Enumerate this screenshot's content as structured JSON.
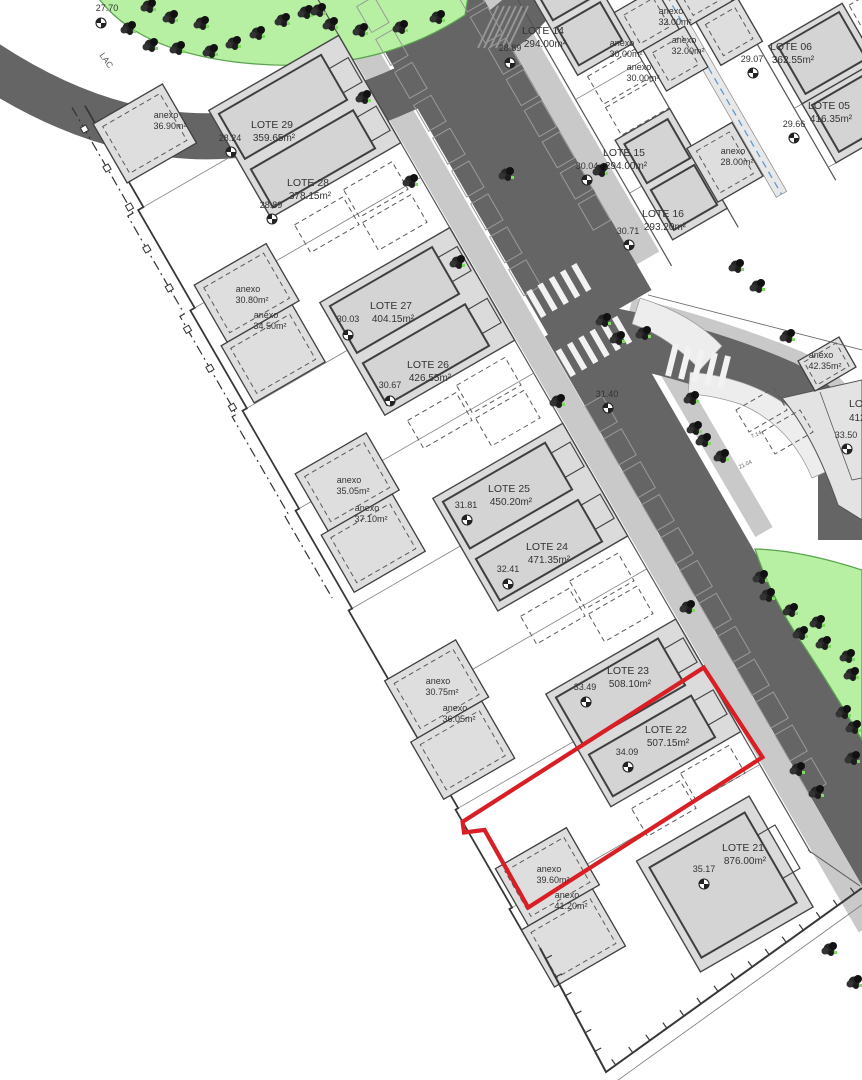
{
  "plan": {
    "boundary_label": {
      "text": "LAC",
      "pos": [
        104,
        62
      ],
      "rotate": 55
    },
    "colors": {
      "highlight": "#d81f26",
      "road": "#656565",
      "sidewalk": "#c9c9c9",
      "parcel_band": "#dbdbdb",
      "green_area": "#b7f0a3",
      "green_stroke": "#5aa34e",
      "line": "#454545",
      "utility_blue": "#5b9bd5"
    },
    "lots": [
      {
        "name": "LOTE 29",
        "area": "359.65m²",
        "elevation": "28.24",
        "highlighted": false,
        "label": [
          272,
          128
        ],
        "elev": [
          230,
          141
        ],
        "marker": [
          231,
          152
        ]
      },
      {
        "name": "LOTE 28",
        "area": "378.15m²",
        "elevation": "28.89",
        "highlighted": false,
        "label": [
          308,
          186
        ],
        "elev": [
          271,
          208
        ],
        "marker": [
          272,
          219
        ]
      },
      {
        "name": "LOTE 27",
        "area": "404.15m²",
        "elevation": "30.03",
        "highlighted": false,
        "label": [
          391,
          309
        ],
        "elev": [
          348,
          322
        ],
        "marker": [
          348,
          335
        ]
      },
      {
        "name": "LOTE 26",
        "area": "426.55m²",
        "elevation": "30.67",
        "highlighted": false,
        "label": [
          428,
          368
        ],
        "elev": [
          390,
          388
        ],
        "marker": [
          390,
          401
        ]
      },
      {
        "name": "LOTE 25",
        "area": "450.20m²",
        "elevation": "31.81",
        "highlighted": false,
        "label": [
          509,
          492
        ],
        "elev": [
          466,
          508
        ],
        "marker": [
          467,
          520
        ]
      },
      {
        "name": "LOTE 24",
        "area": "471.35m²",
        "elevation": "32.41",
        "highlighted": false,
        "label": [
          547,
          550
        ],
        "elev": [
          508,
          572
        ],
        "marker": [
          508,
          584
        ]
      },
      {
        "name": "LOTE 23",
        "area": "508.10m²",
        "elevation": "33.49",
        "highlighted": false,
        "label": [
          628,
          674
        ],
        "elev": [
          585,
          690
        ],
        "marker": [
          586,
          702
        ]
      },
      {
        "name": "LOTE 22",
        "area": "507.15m²",
        "elevation": "34.09",
        "highlighted": true,
        "label": [
          666,
          733
        ],
        "elev": [
          627,
          755
        ],
        "marker": [
          628,
          767
        ]
      },
      {
        "name": "LOTE 21",
        "area": "876.00m²",
        "elevation": "35.17",
        "highlighted": false,
        "label": [
          743,
          851
        ],
        "elev": [
          704,
          872
        ],
        "marker": [
          704,
          884
        ]
      },
      {
        "name": "LOTE 14",
        "area": "294.00m²",
        "elevation": "28.89",
        "highlighted": false,
        "label": [
          543,
          34
        ],
        "elev": [
          510,
          51
        ],
        "marker": [
          510,
          63
        ]
      },
      {
        "name": "LOTE 15",
        "area": "294.00m²",
        "elevation": "30.04",
        "highlighted": false,
        "label": [
          624,
          156
        ],
        "elev": [
          587,
          169
        ],
        "marker": [
          587,
          180
        ]
      },
      {
        "name": "LOTE 16",
        "area": "293.20m²",
        "elevation": "30.71",
        "highlighted": false,
        "label": [
          663,
          217
        ],
        "elev": [
          628,
          234
        ],
        "marker": [
          629,
          245
        ]
      },
      {
        "name": "LOTE 06",
        "area": "362.55m²",
        "elevation": "29.07",
        "highlighted": false,
        "label": [
          791,
          50
        ],
        "elev": [
          752,
          62
        ],
        "marker": [
          753,
          73
        ]
      },
      {
        "name": "LOTE 05",
        "area": "416.35m²",
        "elevation": "29.66",
        "highlighted": false,
        "label": [
          829,
          109
        ],
        "elev": [
          794,
          127
        ],
        "marker": [
          794,
          138
        ]
      }
    ],
    "partial_lot": {
      "name": "LOTE",
      "area": "412",
      "elevation": "33.50",
      "label": [
        849,
        407
      ],
      "elev": [
        846,
        438
      ],
      "marker": [
        847,
        449
      ]
    },
    "annexes": [
      {
        "label": "anexo",
        "area": "36.90m²",
        "pos": [
          166,
          118
        ]
      },
      {
        "label": "anexo",
        "area": "30.80m²",
        "pos": [
          248,
          292
        ]
      },
      {
        "label": "anexo",
        "area": "34.50m²",
        "pos": [
          266,
          318
        ]
      },
      {
        "label": "anexo",
        "area": "35.05m²",
        "pos": [
          349,
          483
        ]
      },
      {
        "label": "anexo",
        "area": "37.10m²",
        "pos": [
          367,
          511
        ]
      },
      {
        "label": "anexo",
        "area": "30.75m²",
        "pos": [
          438,
          684
        ]
      },
      {
        "label": "anexo",
        "area": "36.05m²",
        "pos": [
          455,
          711
        ]
      },
      {
        "label": "anexo",
        "area": "39.60m²",
        "pos": [
          549,
          872
        ]
      },
      {
        "label": "anexo",
        "area": "41.20m²",
        "pos": [
          567,
          898
        ]
      },
      {
        "label": "anexo",
        "area": "32.00m²",
        "pos": [
          671,
          14
        ]
      },
      {
        "label": "anexo",
        "area": "30.00m²",
        "pos": [
          622,
          46
        ]
      },
      {
        "label": "anexo",
        "area": "32.00m²",
        "pos": [
          684,
          43
        ]
      },
      {
        "label": "anexo",
        "area": "30.00m²",
        "pos": [
          639,
          70
        ]
      },
      {
        "label": "anexo",
        "area": "28.00m²",
        "pos": [
          733,
          154
        ]
      },
      {
        "label": "anexo",
        "area": "42.35m²",
        "pos": [
          821,
          358
        ]
      }
    ],
    "spot_elevations": [
      {
        "value": "31.40",
        "pos": [
          607,
          397
        ],
        "marker": [
          608,
          408
        ]
      },
      {
        "value": "27.70",
        "pos": [
          107,
          11
        ],
        "marker": [
          101,
          23
        ]
      }
    ],
    "dimension_labels": [
      {
        "value": "7.14",
        "pos": [
          757,
          436
        ],
        "rotate": -25
      },
      {
        "value": "21.04",
        "pos": [
          746,
          466
        ],
        "rotate": -25
      }
    ]
  }
}
